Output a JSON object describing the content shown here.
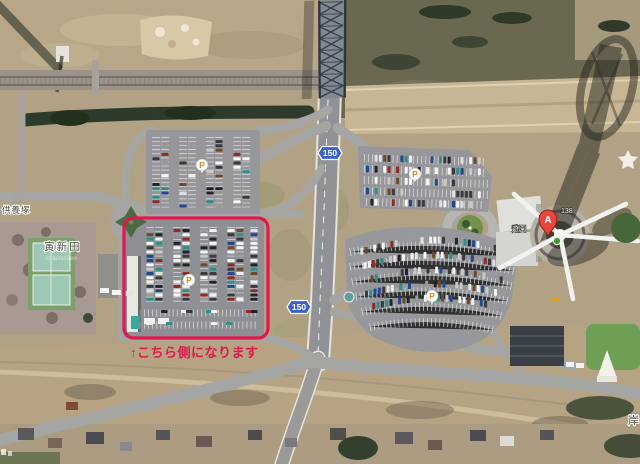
{
  "map": {
    "type": "satellite-aerial-view",
    "annotation": {
      "note_text": "↑こちら側になります",
      "note_color": "#e3164e"
    },
    "highlight_box_color": "#e3164e",
    "shield_color": "#3b63c4",
    "route_shields": [
      {
        "number": "150"
      },
      {
        "number": "150"
      }
    ],
    "markers": {
      "pin_a": {
        "label": "A",
        "color": "#e8453c"
      },
      "parking": {
        "label": "P",
        "color": "#cf8a1d",
        "count": 4
      },
      "tree_poi": {
        "name": "tree-poi",
        "color": "#3d9b35"
      }
    },
    "labels": {
      "village": "寅新田",
      "village_romaji": "Torashinden",
      "mound": "供養塚",
      "edge_partial": "岸",
      "tower_left": "遊園",
      "tower_right": "138"
    }
  }
}
